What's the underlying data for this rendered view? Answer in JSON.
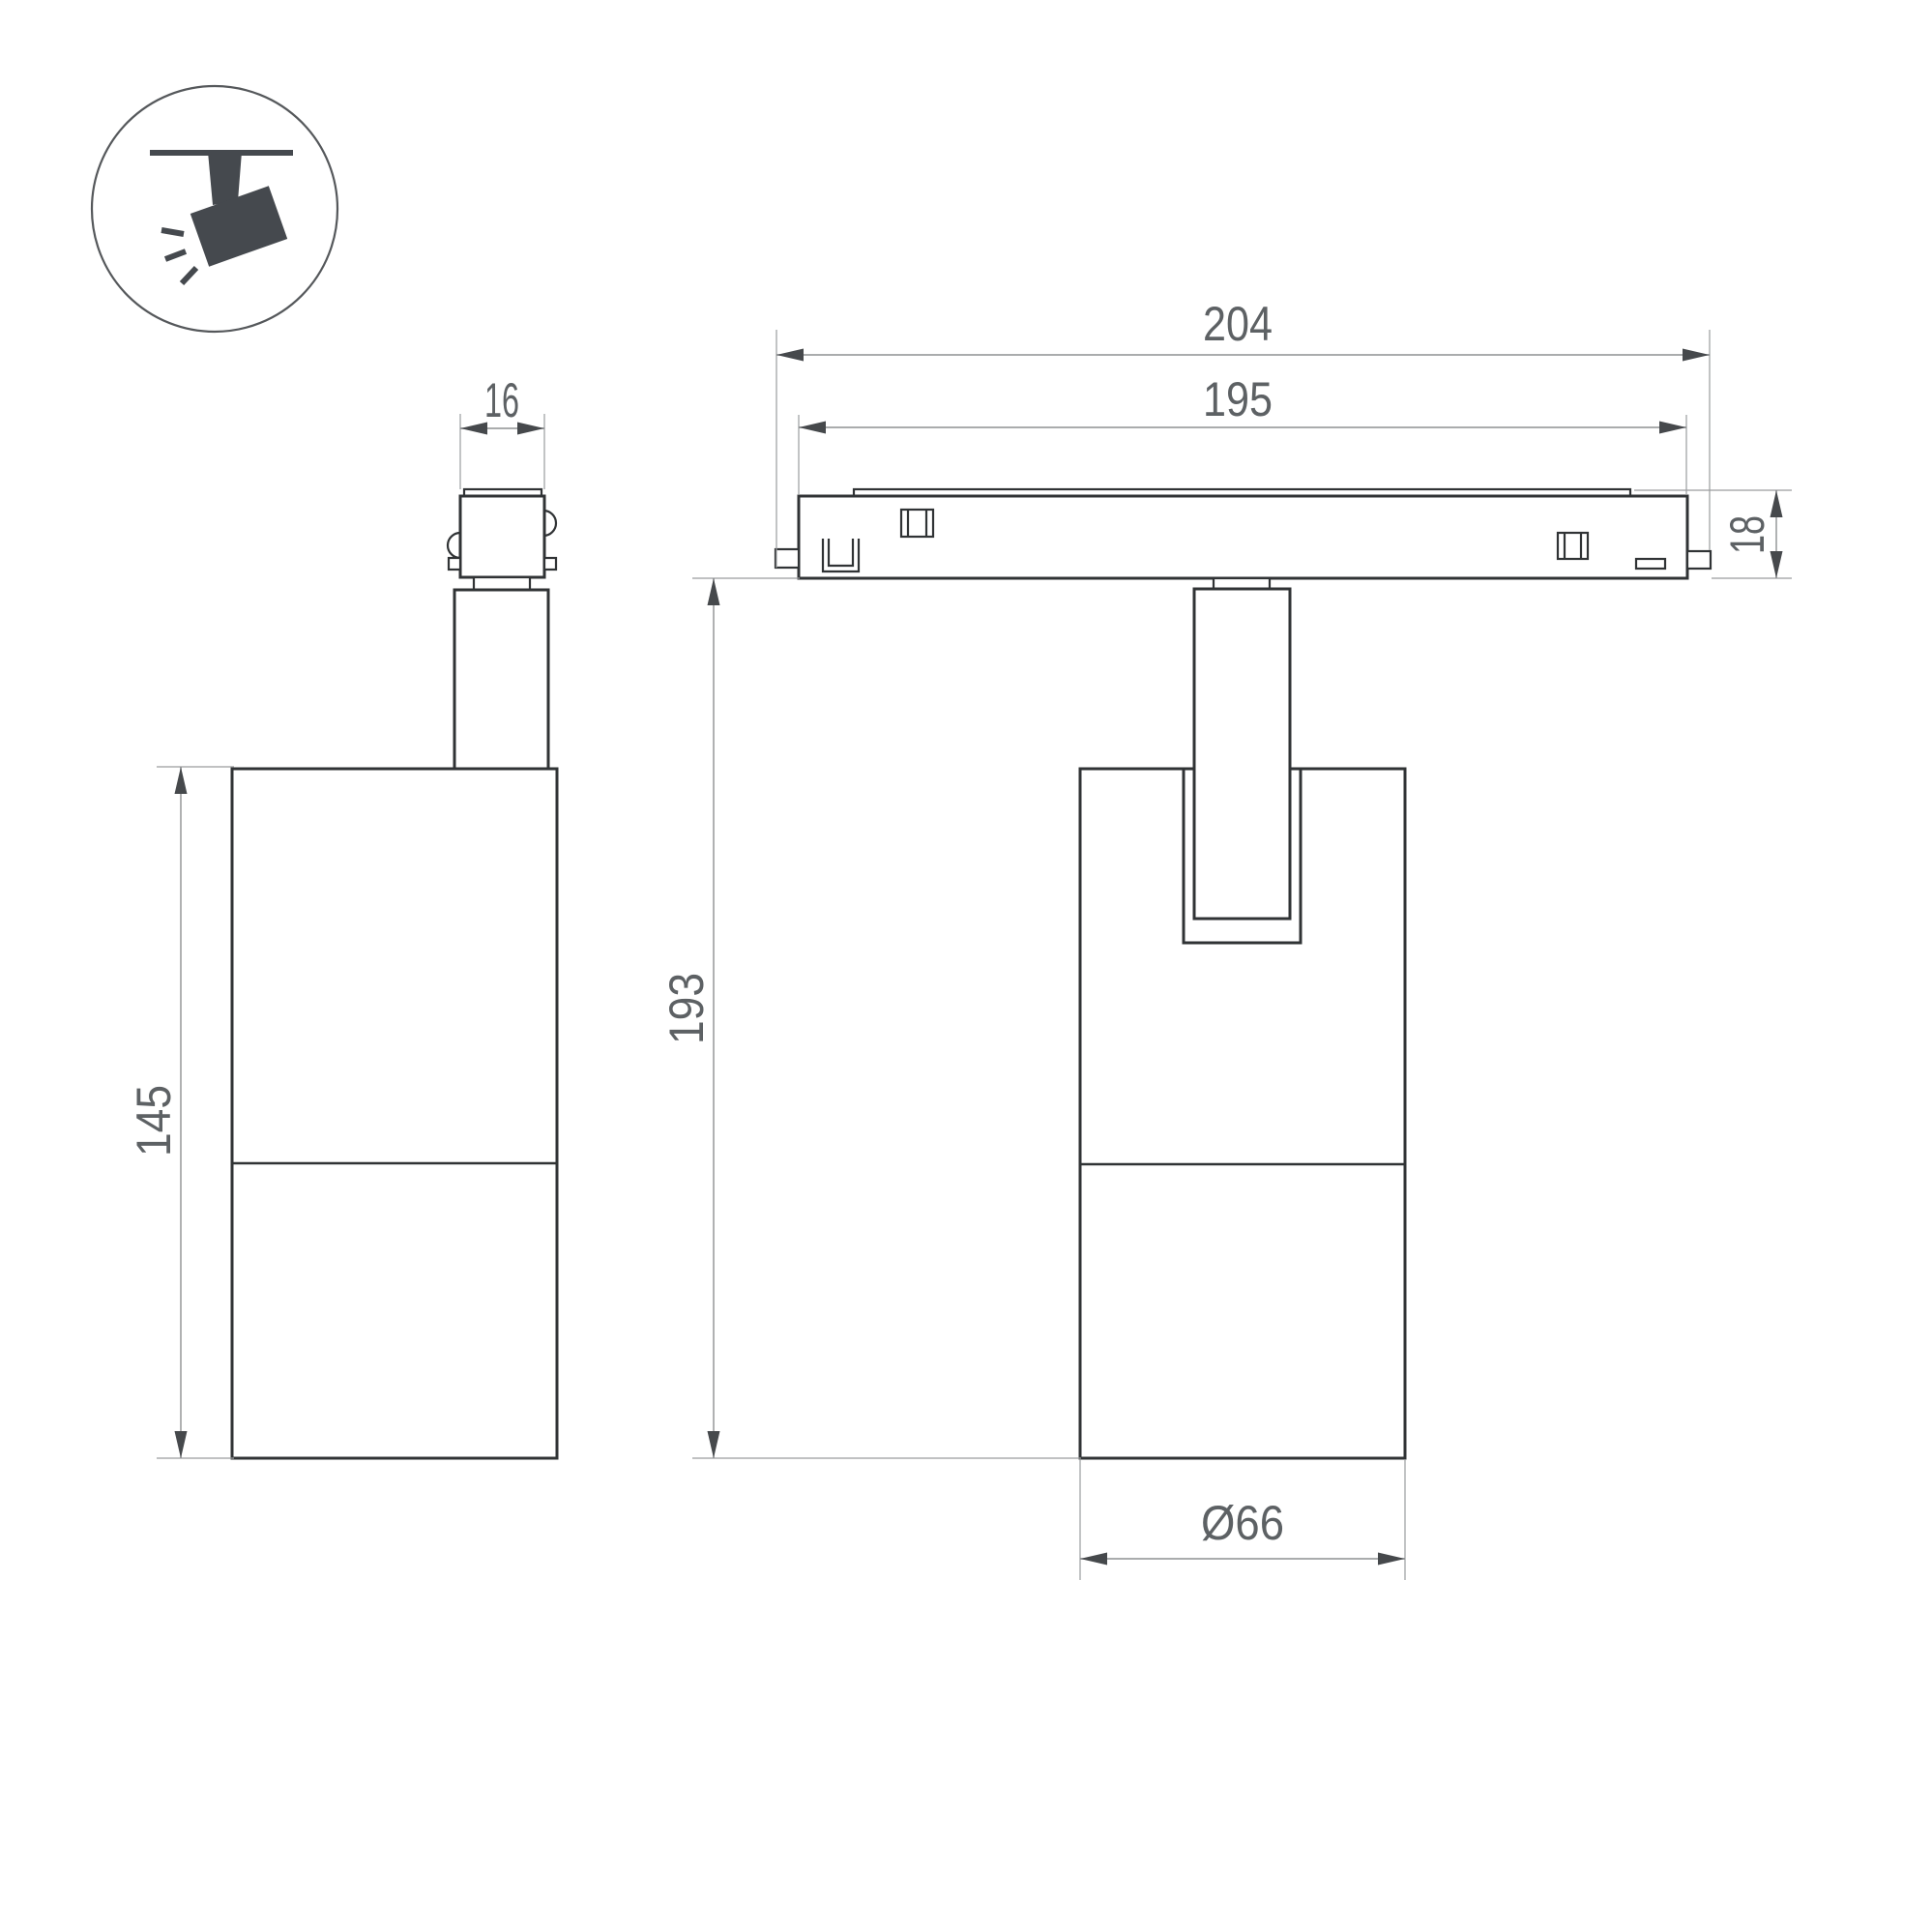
{
  "drawing": {
    "background_color": "#ffffff",
    "outline_color": "#303335",
    "dimension_line_color": "#8e9092",
    "text_color": "#5d6164",
    "icon": {
      "name": "ceiling-track-spotlight-icon",
      "color": "#45494e"
    },
    "views": {
      "side_view": {
        "dims": {
          "adapter_width": "16",
          "body_height": "145"
        }
      },
      "front_view": {
        "dims": {
          "track_length_overall": "204",
          "track_length_inner": "195",
          "track_height": "18",
          "overall_drop_height": "193",
          "body_diameter": "Ø66"
        }
      }
    }
  }
}
